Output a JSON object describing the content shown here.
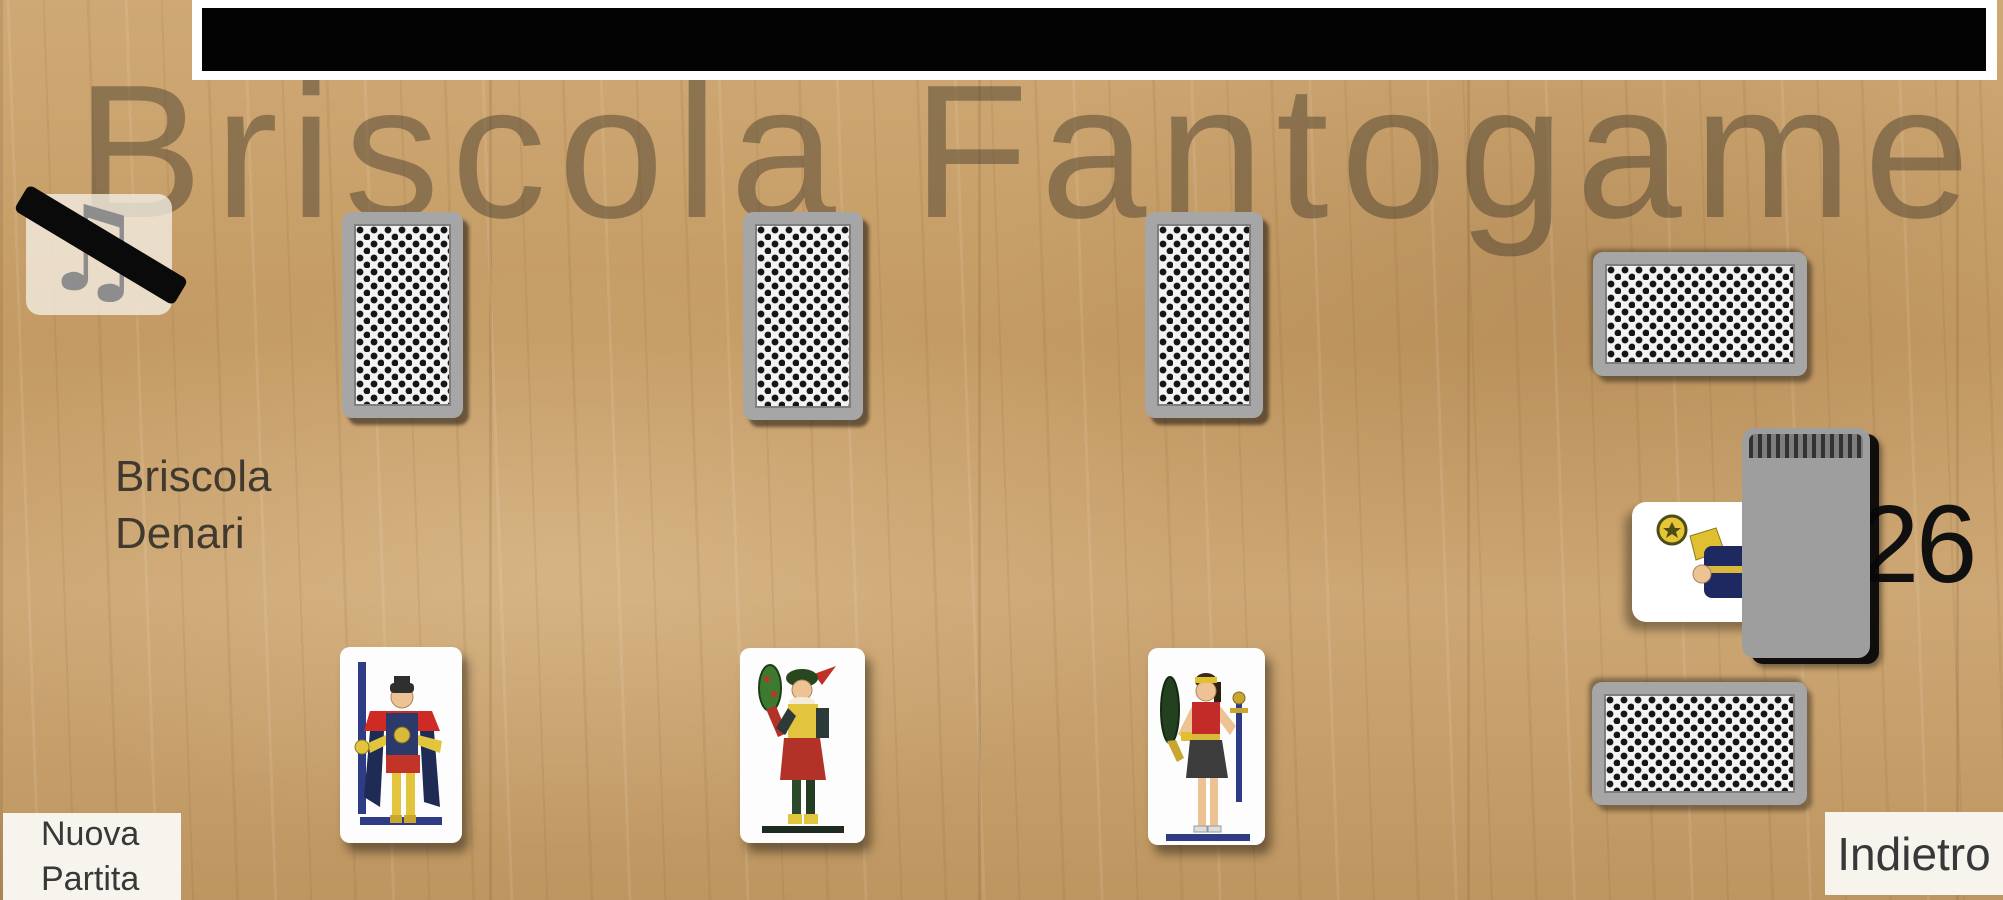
{
  "app": {
    "watermark_title": "Briscola Fantogame"
  },
  "ad_banner": {
    "content": ""
  },
  "sound_button": {
    "state": "muted",
    "icon": "music-note-muted"
  },
  "briscola_indicator": {
    "line1": "Briscola",
    "line2": "Denari"
  },
  "deck": {
    "count": "26",
    "briscola_card": "carta di Denari (parzialmente coperta)"
  },
  "opponent_hand": {
    "facedown_cards": 3
  },
  "captured_piles": {
    "top_right": "pila carte coperte",
    "bottom_right": "pila carte coperte"
  },
  "player_hand": {
    "cards": [
      {
        "name": "figura con spada"
      },
      {
        "name": "figura con bastone"
      },
      {
        "name": "figura con bastone e spada"
      }
    ]
  },
  "buttons": {
    "new_game": "Nuova Partita",
    "back": "Indietro"
  },
  "colors": {
    "wood": "#c6a06b",
    "card_back_gray": "#a6a6a6",
    "pattern_black": "#151515",
    "banner_black": "#030303",
    "button_bg": "#f7f4ee",
    "text_dark": "#383838",
    "count_black": "#101010",
    "watermark": "rgba(74,62,45,0.48)"
  }
}
